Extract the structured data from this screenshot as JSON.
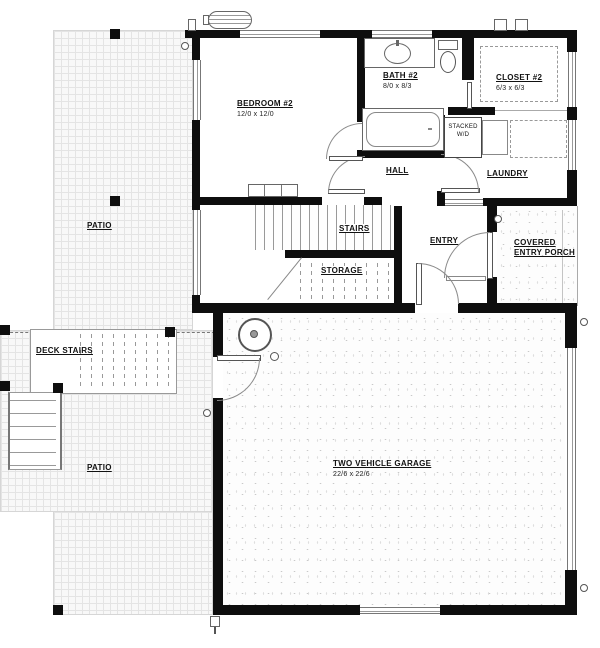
{
  "plan": {
    "rooms": {
      "patio_top": {
        "label": "PATIO"
      },
      "bedroom2": {
        "label": "BEDROOM #2",
        "dims": "12/0 x 12/0"
      },
      "bath2": {
        "label": "BATH #2",
        "dims": "8/0 x 8/3"
      },
      "closet2": {
        "label": "CLOSET #2",
        "dims": "6/3 x 6/3"
      },
      "hall": {
        "label": "HALL"
      },
      "laundry": {
        "label": "LAUNDRY"
      },
      "stacked_wd": {
        "line1": "STACKED",
        "line2": "W/D"
      },
      "stairs": {
        "label": "STAIRS"
      },
      "storage": {
        "label": "STORAGE"
      },
      "entry": {
        "label": "ENTRY"
      },
      "porch": {
        "label": "COVERED ENTRY PORCH"
      },
      "deck_stairs": {
        "label": "DECK STAIRS"
      },
      "patio_bottom": {
        "label": "PATIO"
      },
      "garage": {
        "label": "TWO VEHICLE GARAGE",
        "dims": "22/6 x 22/6"
      }
    },
    "colors": {
      "wall": "#0e0e0e",
      "line": "#8a8a8a",
      "texture_grid": "#e4e4e4"
    }
  }
}
